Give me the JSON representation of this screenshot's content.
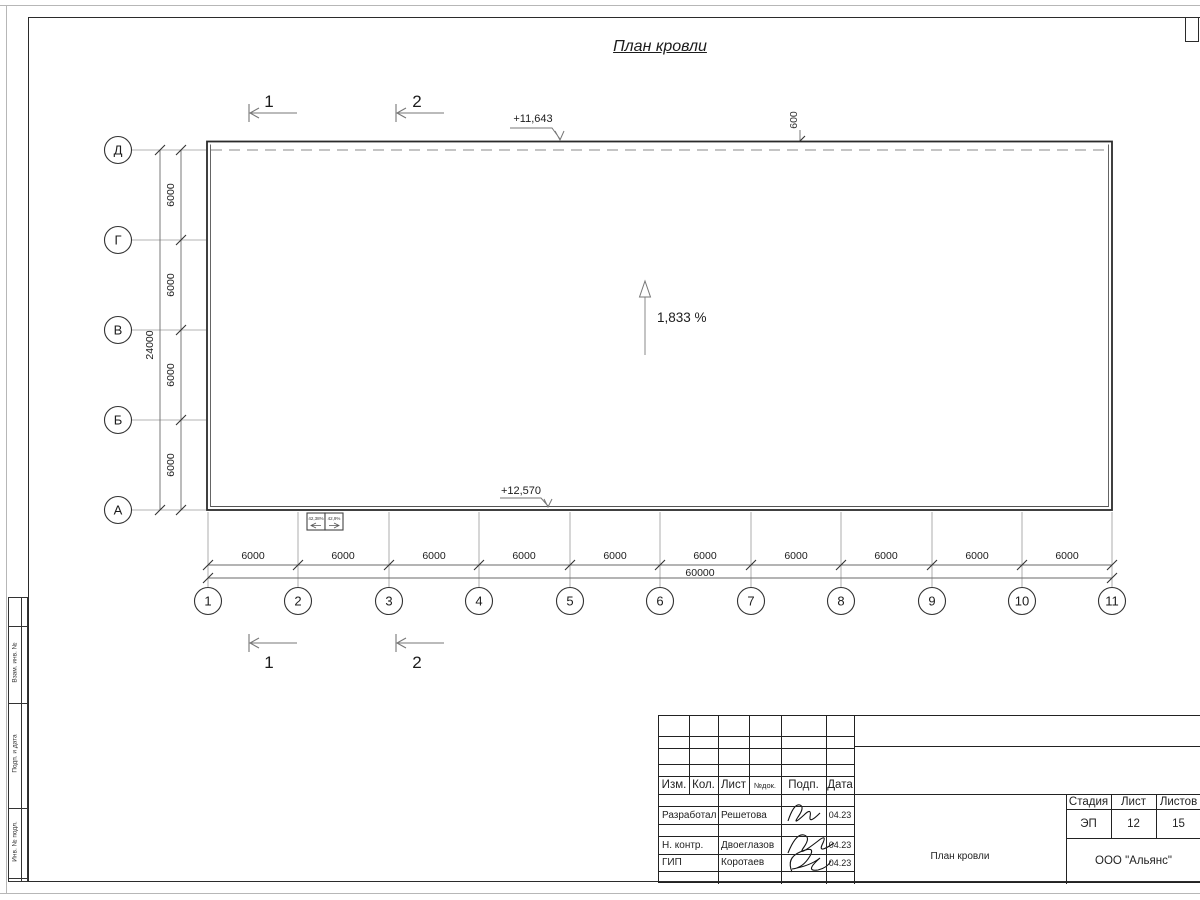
{
  "page": {
    "title": "План кровли"
  },
  "colors": {
    "ink": "#222222",
    "aux_line": "#9a9a9a",
    "dash_line": "#8a8a8a"
  },
  "drawing": {
    "elevation_top": "+11,643",
    "elevation_bottom": "+12,570",
    "slope_label": "1,833 %",
    "overhang_dim": "600",
    "section_marks": {
      "s1": "1",
      "s2": "2"
    },
    "drains": [
      "42,38%",
      "42,9%"
    ],
    "axes": {
      "rows": [
        "Д",
        "Г",
        "В",
        "Б",
        "А"
      ],
      "cols": [
        "1",
        "2",
        "3",
        "4",
        "5",
        "6",
        "7",
        "8",
        "9",
        "10",
        "11"
      ]
    },
    "dims": {
      "col_segments": [
        "6000",
        "6000",
        "6000",
        "6000",
        "6000",
        "6000",
        "6000",
        "6000",
        "6000",
        "6000"
      ],
      "col_total": "60000",
      "row_segments": [
        "6000",
        "6000",
        "6000",
        "6000"
      ],
      "row_total": "24000"
    }
  },
  "frame_strip": {
    "labels": [
      "Взам. инв. №",
      "Подп. и дата",
      "Инв. № подл."
    ]
  },
  "titleblock": {
    "headers": [
      "Изм.",
      "Кол.",
      "Лист",
      "№док.",
      "Подп.",
      "Дата"
    ],
    "rows": [
      {
        "role": "Разработал",
        "name": "Решетова",
        "date": "04.23"
      },
      {
        "role": "Н. контр.",
        "name": "Двоеглазов",
        "date": "04.23"
      },
      {
        "role": "ГИП",
        "name": "Коротаев",
        "date": "04.23"
      }
    ],
    "stage_label": "Стадия",
    "sheet_label": "Лист",
    "sheets_label": "Листов",
    "stage": "ЭП",
    "sheet": "12",
    "sheets": "15",
    "doc_name": "План кровли",
    "company": "ООО \"Альянс\""
  }
}
